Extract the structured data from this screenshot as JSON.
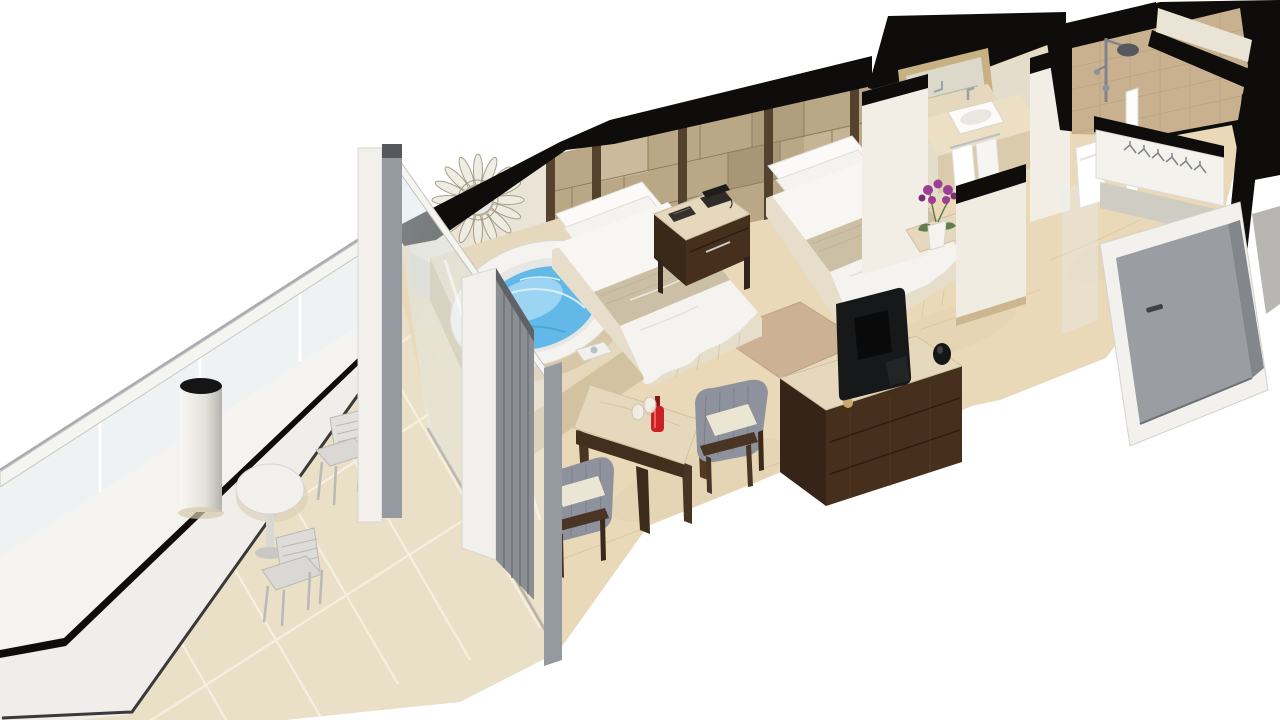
{
  "scene": {
    "title": "3D cutaway floor plan rendering of a hotel guest room with balcony, twin beds, jacuzzi and bathroom",
    "style": "isometric dollhouse render on white background, walls cut away and shown black on top",
    "rooms": [
      {
        "name": "balcony",
        "items": [
          "glass balustrade",
          "slab fascia",
          "round bistro table",
          "metal patio chair near door",
          "metal patio chair near tip",
          "structural column",
          "beige tiled floor"
        ]
      },
      {
        "name": "bedroom",
        "items": [
          "jacuzzi whirlpool tub on marble platform",
          "sunburst wall mirror",
          "sliding glass door with gray curtain",
          "twin bed 1",
          "twin bed 2",
          "nightstand with telephone and notepad",
          "paneled headboard wall",
          "area rug",
          "TV console with flat screen TV and speaker",
          "marble side table with red bottle and two glasses",
          "upholstered armchair right",
          "upholstered armchair left"
        ]
      },
      {
        "name": "bathroom",
        "items": [
          "gold framed vanity mirror",
          "marble vanity counter with white sink and chrome faucet",
          "hanging white towels",
          "purple orchid in white pot on marble ledge",
          "walk-in shower with chrome rain head",
          "glass shower screen with hand towel",
          "beige stone tile walls"
        ]
      },
      {
        "name": "entry",
        "items": [
          "wardrobe closet with hangers",
          "gray entry door with white frame"
        ]
      }
    ]
  },
  "palette": {
    "background": "#ffffff",
    "cut_wall_black": "#0e0d0b",
    "wall_cream": "#eae4d6",
    "wall_cream_bright": "#f2eee5",
    "wall_cream_shadow": "#ddd6c5",
    "headboard_tan": "#b9a786",
    "headboard_divider": "#55422e",
    "floor_marble": "#e9d9b8",
    "floor_vein": "#d5c09a",
    "balcony_tile": "#eadfc7",
    "balcony_grout": "#f6f0e1",
    "railing_white": "#f4f4f1",
    "glass_tint": "#e7eef1",
    "bed_linen": "#f7f6f3",
    "bed_runner": "#cbbfa5",
    "bed_skirt": "#e6decb",
    "wood_dark": "#472f1d",
    "wood_side": "#33241656",
    "marble_counter": "#e6d8bc",
    "water_blue": "#62b9e8",
    "water_light": "#aadcf5",
    "chrome": "#b9bfc5",
    "fabric_gray": "#8e929d",
    "cushion_cream": "#ebe6d4",
    "door_gray": "#9a9da2",
    "door_gray_dark": "#83868b",
    "rug_tan": "#c9ad92",
    "orchid_purple": "#9c3f94",
    "leaf_green": "#5f7d49",
    "shower_tile": "#c9b190",
    "column_top": "#151515",
    "tv_black": "#17181a"
  }
}
